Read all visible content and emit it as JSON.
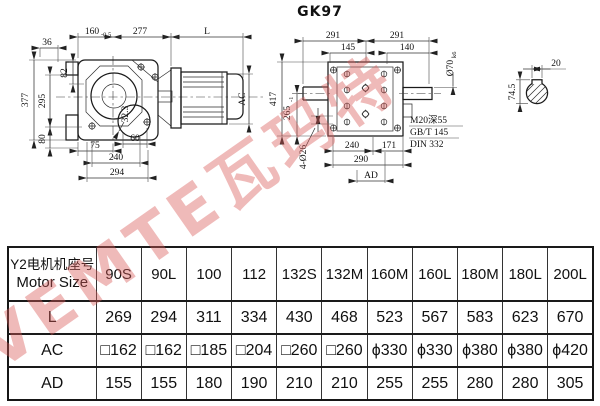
{
  "title": "GK97",
  "watermark": {
    "text": "VEMTE瓦玛特",
    "color": "#d95a58"
  },
  "side_view": {
    "d36": "36",
    "d160": "160",
    "d160_tol": "-0.5",
    "d277": "277",
    "dL": "L",
    "d82": "82",
    "d377": "377",
    "d295": "295",
    "d80": "80",
    "dAC": "AC",
    "d75": "75",
    "d60": "60",
    "d240": "240",
    "d294": "294",
    "d32_3": "32.3"
  },
  "front_view": {
    "d291l": "291",
    "d291r": "291",
    "d145": "145",
    "d140": "140",
    "shaft_dia": "Ø70",
    "shaft_fit": "k6",
    "d417": "417",
    "d265": "265",
    "d265_tol": "-1",
    "d_holes": "4-Ø26",
    "d240": "240",
    "d171": "171",
    "d290": "290",
    "dAD": "AD",
    "note_tap": "M20深55",
    "note_std1": "GB/T 145",
    "note_std2": "DIN 332"
  },
  "key_section": {
    "d20": "20",
    "d74_5": "74.5"
  },
  "table": {
    "header": {
      "line1": "Y2电机机座号",
      "line2": "Motor Size"
    },
    "columns": [
      "90S",
      "90L",
      "100",
      "112",
      "132S",
      "132M",
      "160M",
      "160L",
      "180M",
      "180L",
      "200L"
    ],
    "rows": [
      {
        "label": "L",
        "values": [
          "269",
          "294",
          "311",
          "334",
          "430",
          "468",
          "523",
          "567",
          "583",
          "623",
          "670"
        ]
      },
      {
        "label": "AC",
        "values": [
          "□162",
          "□162",
          "□185",
          "□204",
          "□260",
          "□260",
          "ϕ330",
          "ϕ330",
          "ϕ380",
          "ϕ380",
          "ϕ420"
        ]
      },
      {
        "label": "AD",
        "values": [
          "155",
          "155",
          "180",
          "190",
          "210",
          "210",
          "255",
          "255",
          "280",
          "280",
          "305"
        ]
      }
    ]
  }
}
